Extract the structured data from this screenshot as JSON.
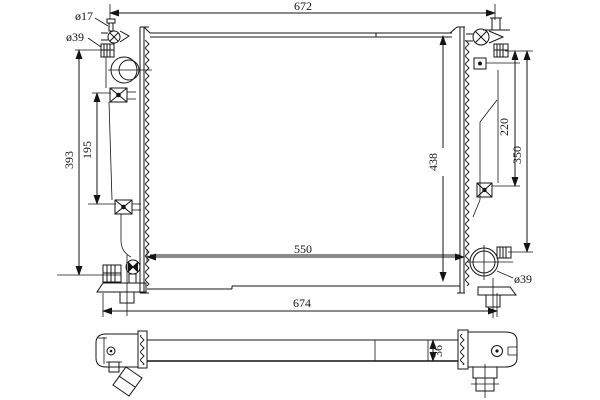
{
  "drawing": {
    "background_color": "#ffffff",
    "line_color": "#141414",
    "subject": "radiator technical drawing, front view and bottom profile view",
    "labels": {
      "width_top": "672",
      "width_bottom": "674",
      "core_width": "550",
      "height_overall": "438",
      "height_left_ports": "393",
      "left_bracket_span": "195",
      "right_upper_span": "220",
      "right_lower_span": "350",
      "core_depth": "36",
      "filler_neck_dia": "ø17",
      "inlet_dia": "ø39",
      "outlet_dia": "ø39"
    }
  }
}
